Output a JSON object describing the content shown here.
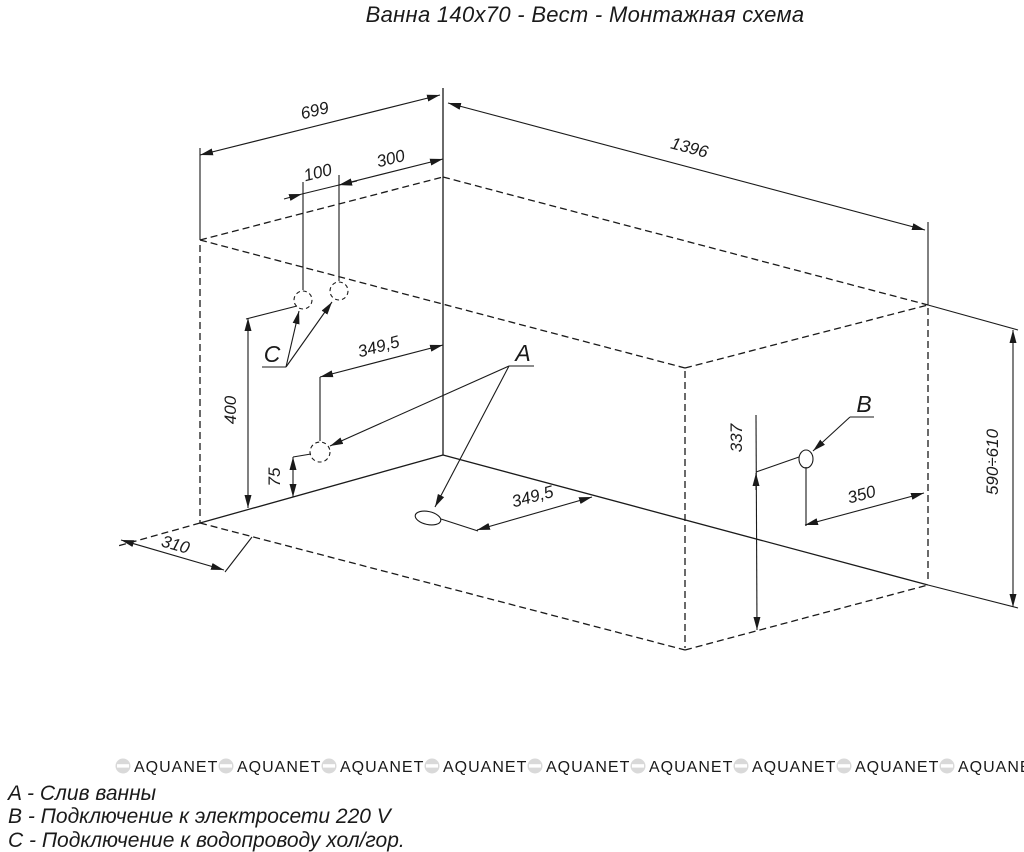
{
  "title": "Ванна 140х70 - Вест - Монтажная схема",
  "labels": {
    "drain": "A",
    "electric": "B",
    "water": "C"
  },
  "dimensions": {
    "wall_width": "699",
    "tub_length": "1396",
    "pipe_gap": "100",
    "pipe_corner_offset": "300",
    "drain_axis_wall": "349,5",
    "drain_axis_floor": "349,5",
    "water_height": "400",
    "drain_wall_height": "75",
    "floor_strip": "310",
    "electric_height": "337",
    "electric_offset": "350",
    "tub_height_range": "590÷610"
  },
  "legend": {
    "items": [
      {
        "key": "A",
        "text": "A - Слив ванны"
      },
      {
        "key": "B",
        "text": "B - Подключение к электросети 220 V"
      },
      {
        "key": "C",
        "text": "C - Подключение к водопроводу хол/гор."
      }
    ]
  },
  "watermark": {
    "text": "AQUANET",
    "color": "#d9d9d9"
  },
  "colors": {
    "line": "#1a1a1a",
    "background": "#ffffff"
  }
}
